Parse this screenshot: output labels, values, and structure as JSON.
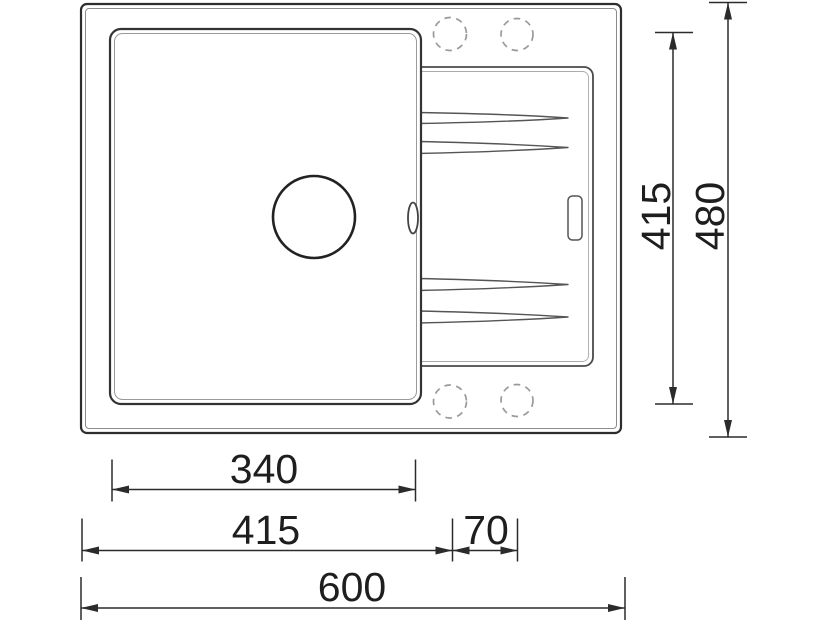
{
  "drawing": {
    "type": "technical-drawing-top-view",
    "subject": "kitchen sink with main bowl and drainboard",
    "background_color": "#ffffff",
    "outline_color": "#2d2d2d",
    "secondary_line_color": "#8b8b8b",
    "dashed_hole_color": "#999999",
    "icons": [
      "drain-hole-icon",
      "overflow-slot-icon",
      "faucet-hole-icon",
      "drain-groove-icon"
    ]
  },
  "dimensions": {
    "bowl_width_mm": "340",
    "edge_to_faucet_mm": "415",
    "faucet_spacing_mm": "70",
    "overall_width_mm": "600",
    "bowl_depth_mm": "415",
    "overall_depth_mm": "480"
  }
}
